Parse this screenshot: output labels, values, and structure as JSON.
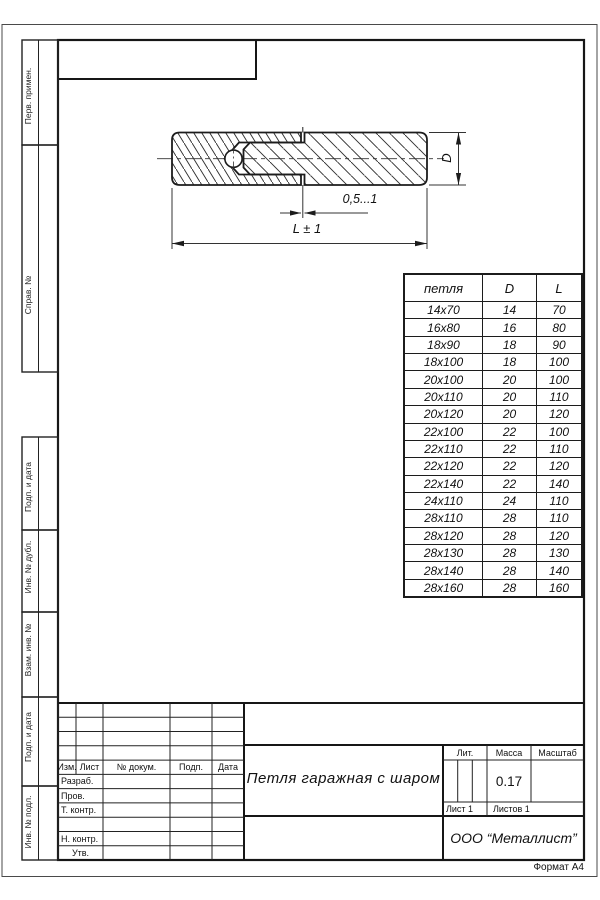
{
  "meta": {
    "format_label": "Формат А4"
  },
  "sidebar": {
    "labels": [
      "Перв. примен.",
      "Справ. №",
      "Подп. и дата",
      "Инв. № дубл.",
      "Взам. инв. №",
      "Подп. и дата",
      "Инв. № подл."
    ]
  },
  "drawing": {
    "dim_gap": "0,5...1",
    "dim_length": "L ± 1",
    "dim_diameter": "D"
  },
  "table": {
    "headers": [
      "петля",
      "D",
      "L"
    ],
    "rows": [
      [
        "14x70",
        "14",
        "70"
      ],
      [
        "16x80",
        "16",
        "80"
      ],
      [
        "18x90",
        "18",
        "90"
      ],
      [
        "18x100",
        "18",
        "100"
      ],
      [
        "20x100",
        "20",
        "100"
      ],
      [
        "20x110",
        "20",
        "110"
      ],
      [
        "20x120",
        "20",
        "120"
      ],
      [
        "22x100",
        "22",
        "100"
      ],
      [
        "22x110",
        "22",
        "110"
      ],
      [
        "22x120",
        "22",
        "120"
      ],
      [
        "22x140",
        "22",
        "140"
      ],
      [
        "24x110",
        "24",
        "110"
      ],
      [
        "28x110",
        "28",
        "110"
      ],
      [
        "28x120",
        "28",
        "120"
      ],
      [
        "28x130",
        "28",
        "130"
      ],
      [
        "28x140",
        "28",
        "140"
      ],
      [
        "28x160",
        "28",
        "160"
      ]
    ]
  },
  "title_block": {
    "header_cols": [
      "Изм.",
      "Лист",
      "№ докум.",
      "Подп.",
      "Дата"
    ],
    "row_labels": [
      "Разраб.",
      "Пров.",
      "Т. контр.",
      "Н. контр.",
      "Утв."
    ],
    "title": "Петля гаражная  с шаром",
    "lit_label": "Лит.",
    "mass_label": "Масса",
    "scale_label": "Масштаб",
    "mass_value": "0.17",
    "sheet_label": "Лист 1",
    "sheets_label": "Листов 1",
    "org": "ООО “Металлист”"
  },
  "colors": {
    "line": "#1c1c1c",
    "paper": "#ffffff"
  }
}
